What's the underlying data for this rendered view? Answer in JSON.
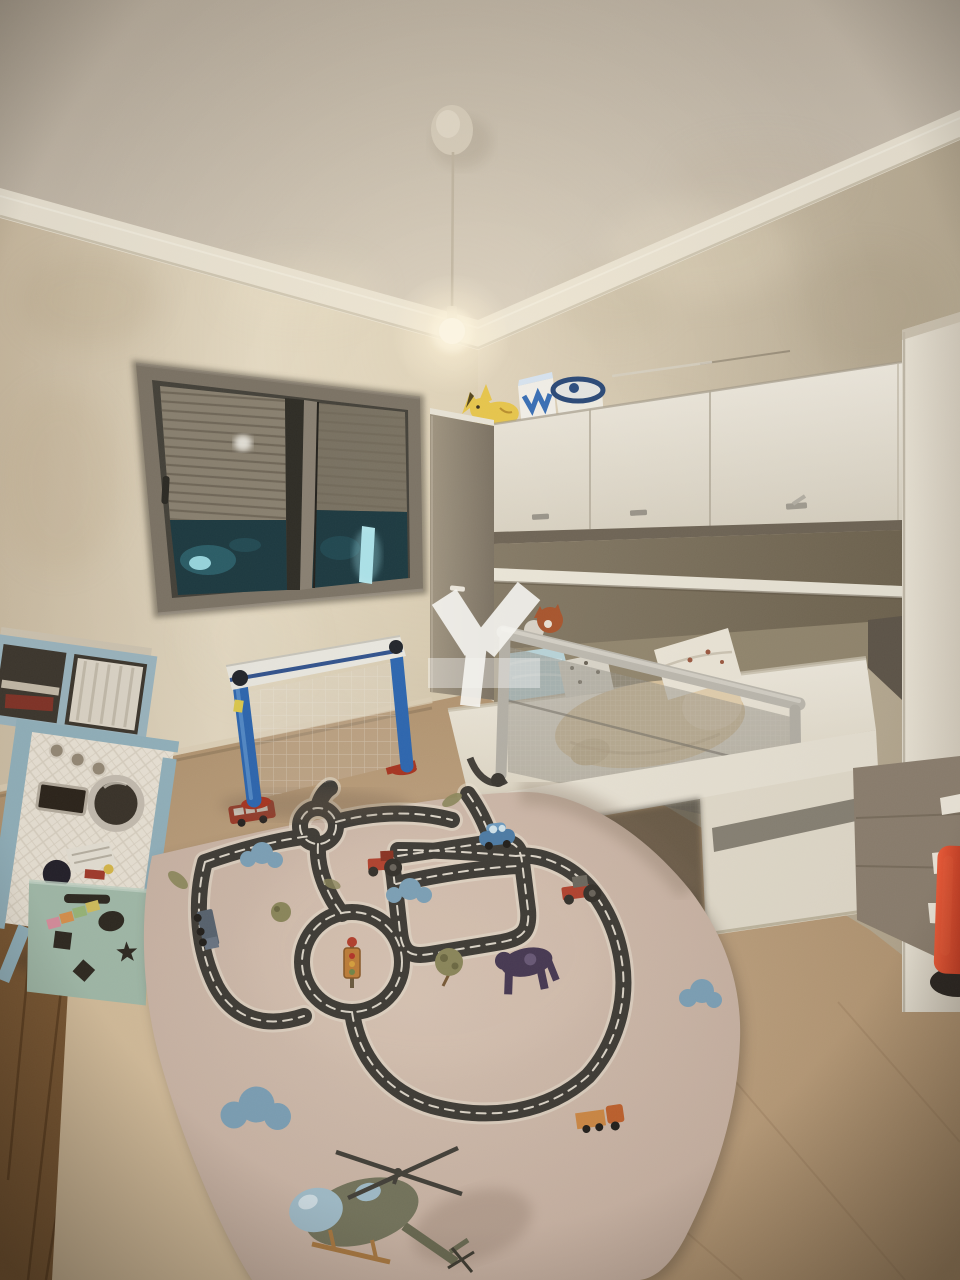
{
  "photo": {
    "kind": "children-bedroom-night-photo",
    "bed": {
      "rail_brand_text": "innd"
    },
    "watermark": {
      "shape": "white Y-shaped agency logo with translucent band",
      "text": ""
    },
    "objects": [
      {
        "name": "pendant-light",
        "label": "bare bulb pendant light"
      },
      {
        "name": "window-roller-shutter",
        "label": "window with half-lowered roller shutter, night outside"
      },
      {
        "name": "wall-cabinets",
        "label": "white overhead cabinets with gray handles"
      },
      {
        "name": "plush-pikachu",
        "label": "yellow plush on top of cabinets"
      },
      {
        "name": "storage-basket",
        "label": "basket and box on top of cabinets"
      },
      {
        "name": "toddler-bed",
        "label": "white bed with gray mesh bed guard"
      },
      {
        "name": "plush-dog",
        "label": "tan plush lying on mattress"
      },
      {
        "name": "pillow",
        "label": "white printed pillow"
      },
      {
        "name": "wardrobe-column",
        "label": "tall white wardrobe panel right side"
      },
      {
        "name": "drawer-unit",
        "label": "taupe drawer unit with white handles"
      },
      {
        "name": "red-toy",
        "label": "red toy at bottom right"
      },
      {
        "name": "toy-washing-machine",
        "label": "blue framed toy washing machine"
      },
      {
        "name": "toy-shelf",
        "label": "blue toy shelf on top of washing machine"
      },
      {
        "name": "toy-box",
        "label": "green shape-sorter toy box with toys"
      },
      {
        "name": "football-goal",
        "label": "blue mini football goal with net"
      },
      {
        "name": "road-play-rug",
        "label": "road play rug with cars, roundabouts, helicopter"
      },
      {
        "name": "wood-floor",
        "label": "wooden floor strip at left"
      },
      {
        "name": "tile-floor",
        "label": "beige tiled floor"
      }
    ]
  },
  "colors": {
    "ceiling_a": "#b2a797",
    "ceiling_b": "#d1c7b8",
    "molding": "#eae3d3",
    "wall_left_a": "#c8b89e",
    "wall_left_b": "#e4d9c2",
    "wall_right_a": "#dacdb6",
    "wall_right_b": "#b4a78f",
    "floor_a": "#cbaf8e",
    "floor_b": "#a2845f",
    "wood": "#7b5833",
    "platform": "#d6bf9d",
    "rug_a": "#d8c4b4",
    "rug_b": "#c2ab9c",
    "road": "#403d37",
    "road_edge": "#e9e1d1",
    "cab_white_a": "#f1ece1",
    "cab_white_b": "#d8d1c1",
    "col_gray_a": "#a09581",
    "col_gray_b": "#7c7263",
    "niche": "#857a66",
    "shelf": "#e9e4d6",
    "bedback": "#93876f",
    "mattress": "#efeade",
    "bedframe": "#e8e2d4",
    "rail": "#b8b4aa",
    "wardrobe_a": "#ebe5d7",
    "wardrobe_b": "#d3cbbc",
    "drawer": "#8d8070",
    "red_toy": "#d8402a",
    "goal_blue": "#2e67b0",
    "pad_white": "#eae8e0",
    "shutter": "#8b8271",
    "win_frame": "#7d7466",
    "night": "#1d3a41",
    "glass_glow": "#9fdde6",
    "plush": "#d8c29d",
    "pillow": "#ebe5d7",
    "blanket": "#b9d3d8",
    "fox": "#a8562e",
    "toybox": "#a3bcab",
    "toy_blue": "#93b2bd",
    "pika": "#e7c64d",
    "heli": "#76765e",
    "heli_glass": "#a3bfcc",
    "warm_glow": "#fff3d8"
  }
}
